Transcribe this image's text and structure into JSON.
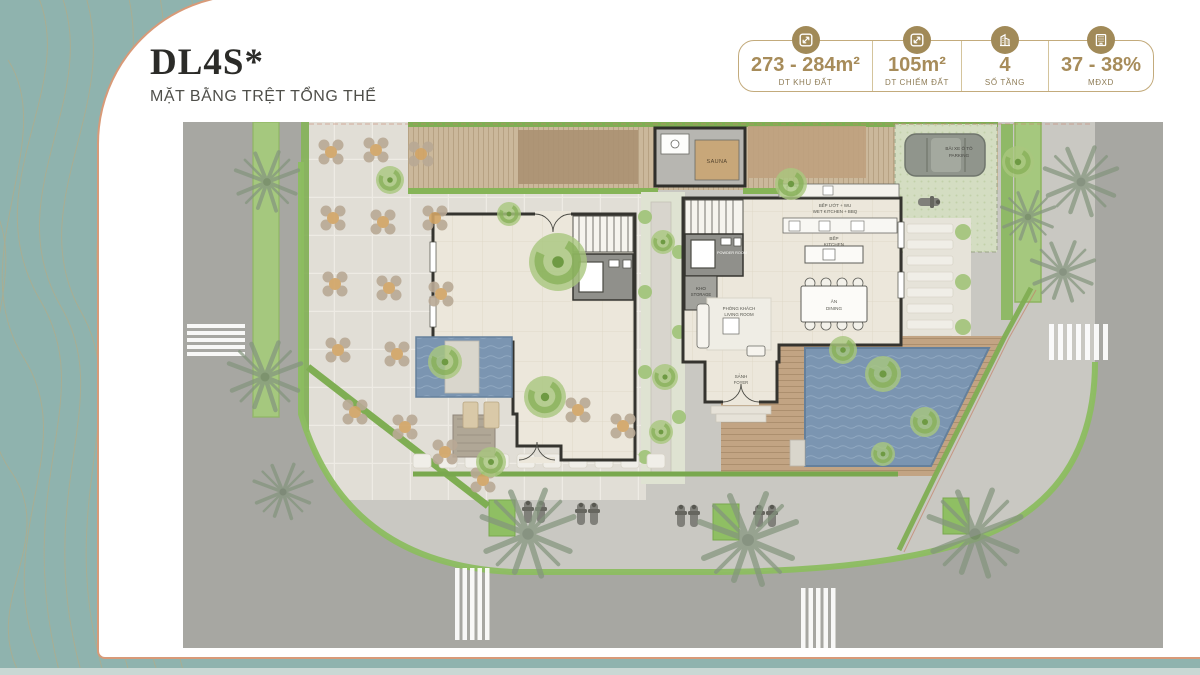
{
  "page": {
    "title": "DL4S*",
    "subtitle": "MẶT BẰNG TRỆT TỔNG THỂ"
  },
  "colors": {
    "background_teal": "#8fb3ae",
    "card_border_copper": "#d89a78",
    "bronze_text": "#a78c5a",
    "icon_gold": "#a18a58",
    "pool_blue": "#7b95b1",
    "landscape_green": "#8cbd60",
    "road_gray": "#a7a7a2"
  },
  "stats": {
    "items": [
      {
        "icon": "area-icon",
        "value": "273 - 284m²",
        "label": "DT KHU ĐẤT"
      },
      {
        "icon": "area-icon",
        "value": "105m²",
        "label": "DT CHIẾM ĐẤT"
      },
      {
        "icon": "floors-icon",
        "value": "4",
        "label": "SỐ TẦNG"
      },
      {
        "icon": "density-icon",
        "value": "37 - 38%",
        "label": "MĐXD"
      }
    ]
  },
  "plan": {
    "labels": {
      "sauna": "SAUNA",
      "wet_kitchen_vi": "BẾP ƯỚT + WU",
      "wet_kitchen_en": "WET KITCHEN + BBQ",
      "powder_room": "POWDER ROOM",
      "storage_vi": "KHO",
      "storage_en": "STORAGE",
      "kitchen_vi": "BẾP",
      "kitchen_en": "KITCHEN",
      "living_vi": "PHÒNG KHÁCH",
      "living_en": "LIVING ROOM",
      "dining_vi": "ĂN",
      "dining_en": "DINING",
      "foyer_vi": "SẢNH",
      "foyer_en": "FOYER",
      "parking_vi": "BÃI XE Ô TÔ",
      "parking_en": "PARKING"
    }
  }
}
